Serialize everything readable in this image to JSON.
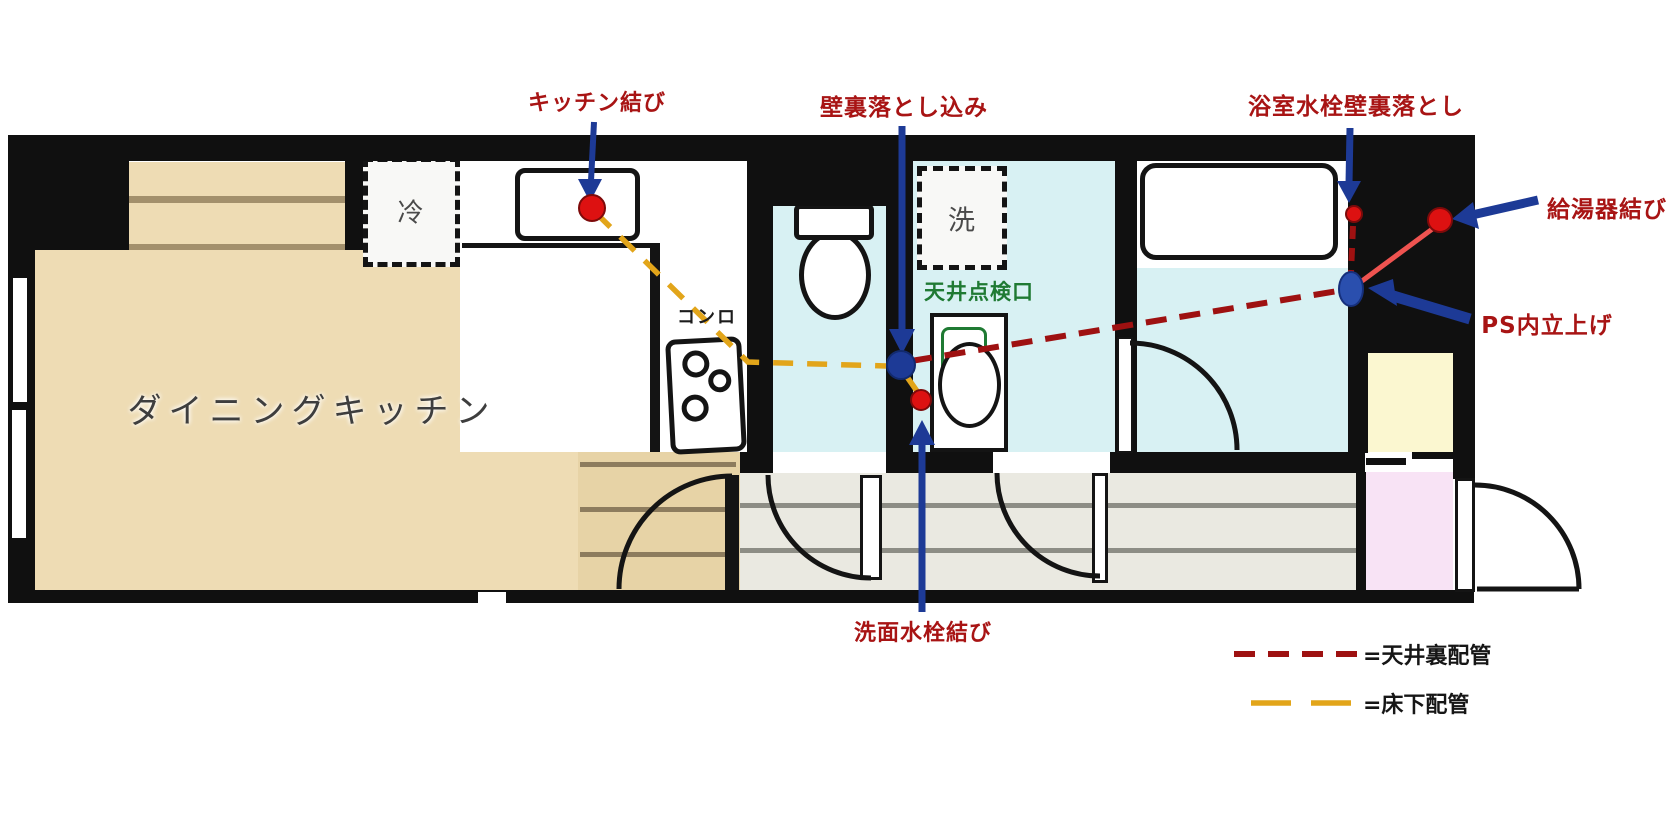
{
  "rooms": {
    "dining_kitchen": "ダイニングキッチン",
    "fridge": "冷",
    "washer": "洗",
    "stove": "コンロ"
  },
  "annotations": {
    "kitchen_tie": "キッチン結び",
    "wall_drop": "壁裏落とし込み",
    "bath_wall_drop": "浴室水栓壁裏落とし",
    "heater_tie": "給湯器結び",
    "ps_riser": "PS内立上げ",
    "basin_tie": "洗面水栓結び",
    "ceiling_port": "天井点検口"
  },
  "legend": {
    "ceiling_pipe": "=天井裏配管",
    "floor_pipe": "=床下配管"
  },
  "colors": {
    "wall": "#101010",
    "tan": "#eedcb4",
    "tan_striped": "#e7d3a6",
    "stripe": "#8d7c5e",
    "light_blue": "#d8f1f3",
    "corridor": "#eae9e1",
    "corridor_stripe": "#8d8d85",
    "cream": "#fbf7d0",
    "pink": "#f8e3f5",
    "label_red": "#a81414",
    "pipe_red": "#9e1111",
    "pipe_yellow": "#e2a51a",
    "pink_line": "#ef5350",
    "blue": "#1d3a96",
    "dot_red": "#dd1111",
    "green": "#1f7a33"
  }
}
